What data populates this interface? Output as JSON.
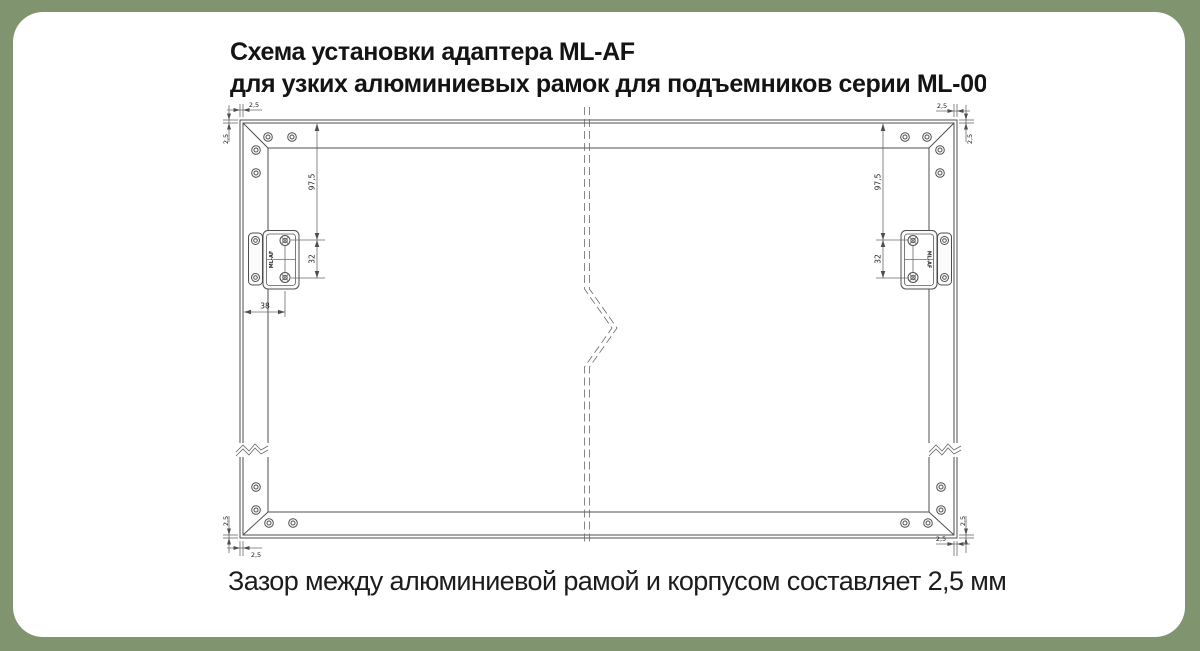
{
  "colors": {
    "background": "#80946F",
    "card": "#FFFFFF",
    "drawing_lines": "#4F4F4F",
    "text": "#1C1C1C"
  },
  "title": {
    "line1": "Схема установки адаптера ML-AF",
    "line2": "для узких алюминиевых рамок для подъемников серии ML-00"
  },
  "caption": "Зазор между алюминиевой рамой и корпусом составляет 2,5 мм",
  "diagram": {
    "adapter_label": "ML-AF",
    "dims": {
      "tl_h": "2,5",
      "tl_v": "2,5",
      "tr_h": "2,5",
      "tr_v": "2,5",
      "bl_h": "2,5",
      "bl_v": "2,5",
      "br_h": "2,5",
      "br_v": "2,5",
      "left_top_offset": "97,5",
      "left_screw_spacing": "32",
      "left_edge_offset": "38",
      "right_top_offset": "97,5",
      "right_screw_spacing": "32"
    }
  }
}
